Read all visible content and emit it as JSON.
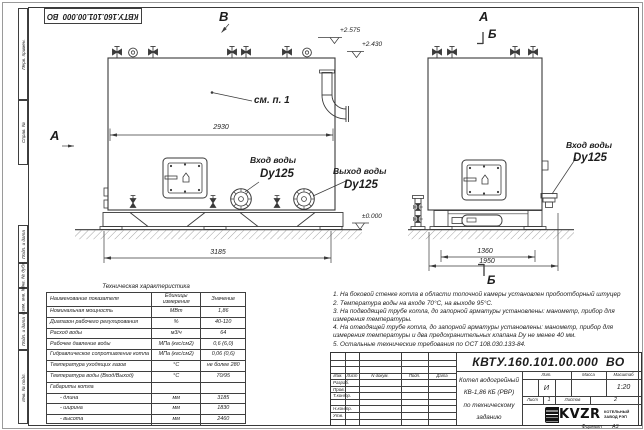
{
  "doc": {
    "number": "КВТУ.160.101.00.000  ВО",
    "format_label": "Формат",
    "format_value": "А3"
  },
  "margin": {
    "items": [
      "Перв. примен.",
      "Справ. №",
      "Подп. и дата",
      "Инв. № дубл.",
      "Взам. инв. №",
      "Подп. и дата",
      "Инв. № подл."
    ]
  },
  "drawing": {
    "view_letters": {
      "v": "В",
      "a_left": "А",
      "a_right": "А",
      "b_top": "Б",
      "b_bottom": "Б"
    },
    "callout": "см. п. 1",
    "elevations": {
      "upper": "+2.575",
      "lower": "+2.430",
      "ground": "±0.000"
    },
    "dims": {
      "left_body": "2930",
      "left_overall": "3185",
      "right_body": "1360",
      "right_overall": "1950"
    },
    "ports": {
      "inlet_left": {
        "title": "Вход воды",
        "size": "Dy125"
      },
      "outlet": {
        "title": "Выход воды",
        "size": "Dy125"
      },
      "inlet_right": {
        "title": "Вход воды",
        "size": "Dy125"
      }
    }
  },
  "tech_table": {
    "title": "Техническая характеристика",
    "headers": [
      "Наименование показателя",
      "Единицы измерения",
      "Значение"
    ],
    "rows": [
      [
        "Номинальная мощность",
        "МВт",
        "1,86"
      ],
      [
        "Диапазон рабочего регулирования",
        "%",
        "40-110"
      ],
      [
        "Расход воды",
        "м3/ч",
        "64"
      ],
      [
        "Рабочее давление воды",
        "МПа (кгс/см2)",
        "0,6 (6,0)"
      ],
      [
        "Гидравлическое сопротивление котла",
        "МПа (кгс/см2)",
        "0,06 (0,6)"
      ],
      [
        "Температура уходящих газов",
        "°С",
        "не более 280"
      ],
      [
        "Температура воды (Вход/Выход)",
        "°С",
        "70/95"
      ],
      [
        "Габариты котла",
        "",
        ""
      ],
      [
        "- длина",
        "мм",
        "3185"
      ],
      [
        "- ширина",
        "мм",
        "1830"
      ],
      [
        "- высота",
        "мм",
        "2460"
      ]
    ]
  },
  "notes": [
    "1.  На боковой стенке котла в области топочной камеры установлен пробоотборный штуцер",
    "2.  Температура воды на входе 70°С, на выходе 95°С.",
    "3.  На подводящей трубе котла, до запорной арматуры установлены: манометр, прибор для измерения температуры.",
    "4.  На отводящей трубе котла, до запорной арматуры установлены: манометр, прибор для измерения температуры и два предохранительных клапана Dу не менее 40 мм.",
    "5.  Остальные технические требования по ОСТ 108.030.133-84."
  ],
  "title_block": {
    "rev_cols": [
      "Изм.",
      "Лист",
      "N докум.",
      "Подп.",
      "Дата"
    ],
    "roles": [
      "Разраб.",
      "Пров.",
      "Т.контр.",
      "Н.контр.",
      "Утв."
    ],
    "title_lines": [
      "Котел водогрейный",
      "КВ-1,86 КБ (РВР)",
      "по техническому заданию"
    ],
    "lit_cols": [
      "Лит.",
      "Масса",
      "Масштаб"
    ],
    "lit_value": "И",
    "scale": "1:20",
    "sheet_label": "Лист",
    "sheet_value": "1",
    "sheets_label": "Листов",
    "sheets_value": "2",
    "logo_text": "KVZR",
    "logo_sub1": "КОТЕЛЬНЫЙ",
    "logo_sub2": "ЗАВОД РЭП"
  }
}
